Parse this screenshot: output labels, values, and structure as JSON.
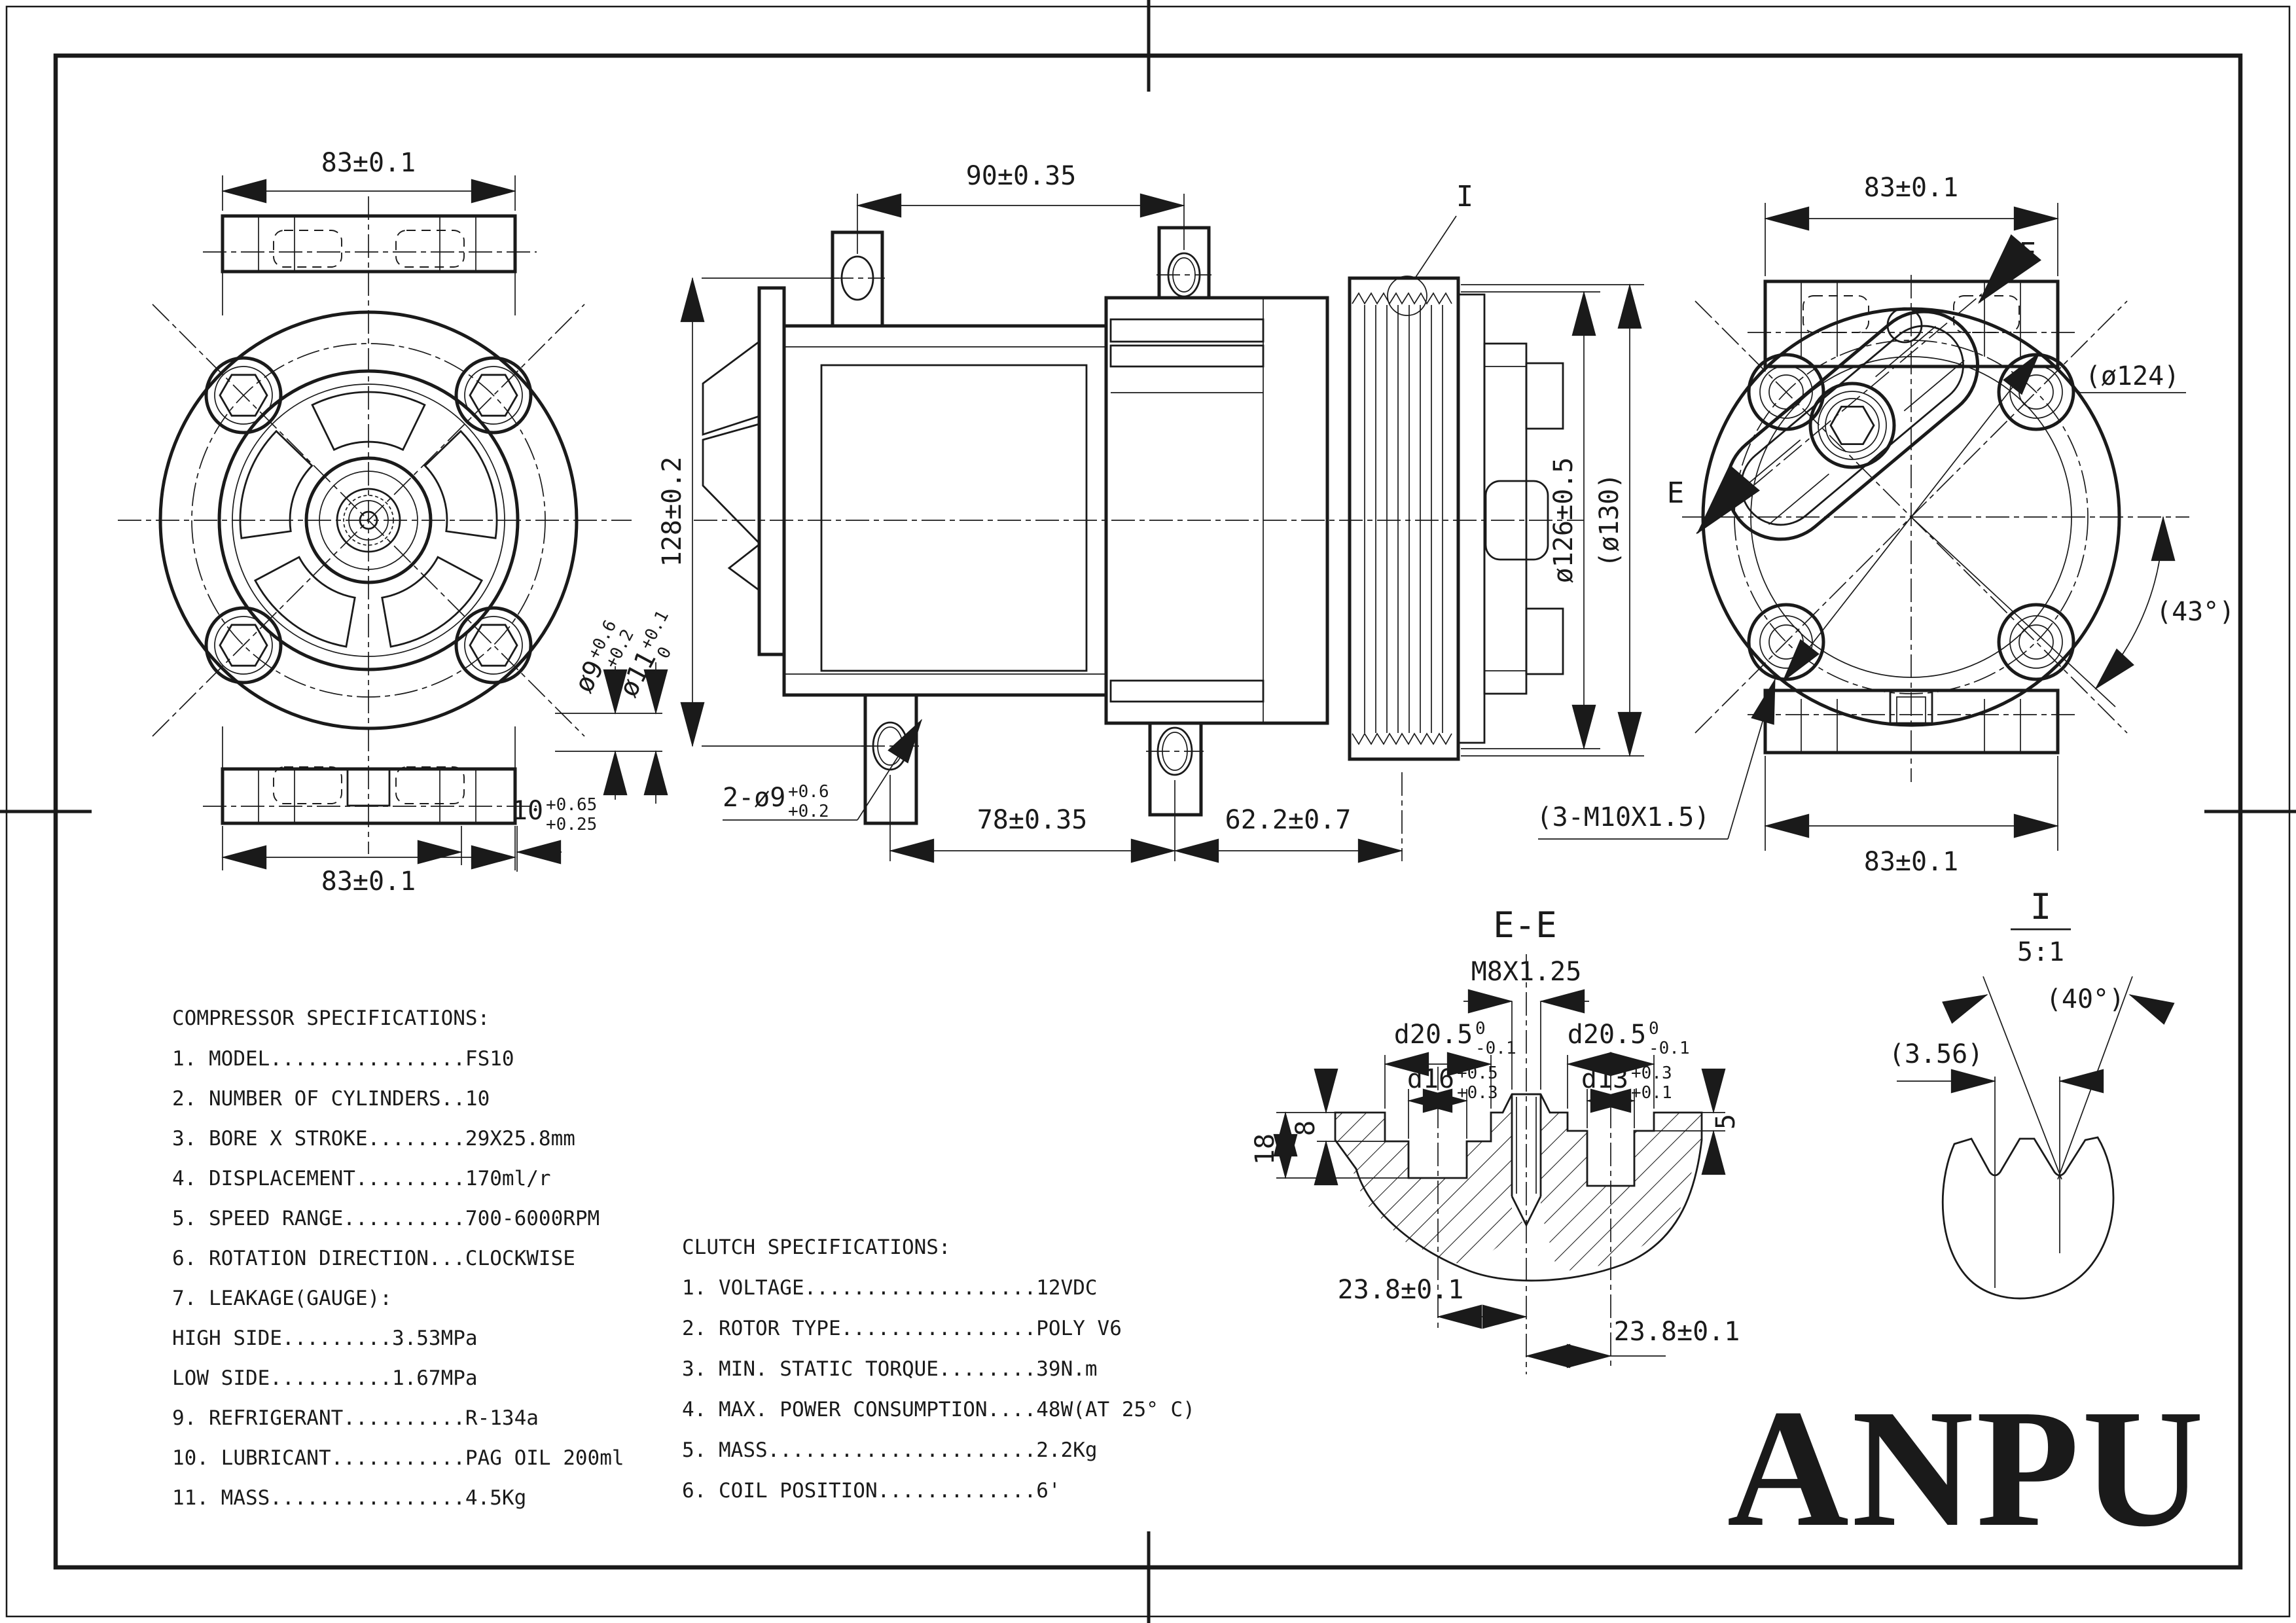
{
  "page": {
    "background": "#ffffff",
    "ink": "#1a1a1a"
  },
  "views": {
    "front_view": {
      "dim_width_top": "83±0.1",
      "dim_width_bottom": "83±0.1",
      "dim_lug_hole": {
        "main": "ø9",
        "sup": "+0.6",
        "sub": "+0.2"
      },
      "dim_lug_boss": {
        "main": "ø11",
        "sup": "+0.1",
        "sub": "0"
      },
      "dim_lug_depth": {
        "main": "10",
        "sup": "+0.65",
        "sub": "+0.25"
      }
    },
    "side_view": {
      "dim_top_lug_span": "90±0.35",
      "dim_body_height": "128±0.2",
      "dim_bottom_holes": {
        "main": "2-ø9",
        "sup": "+0.6",
        "sub": "+0.2"
      },
      "dim_bottom_lug_span": "78±0.35",
      "dim_pulley_offset": "62.2±0.7",
      "dim_pulley_dia": "ø126±0.5",
      "dim_pulley_dia_ref": "(ø130)",
      "detail_marker": "I"
    },
    "rear_view": {
      "dim_width_top": "83±0.1",
      "dim_width_bottom": "83±0.1",
      "dim_dia_ref": "(ø124)",
      "dim_angle_ref": "(43°)",
      "thread_callout": "(3-M10X1.5)",
      "section_label_start": "E",
      "section_label_end": "E"
    }
  },
  "section_ee": {
    "title": "E-E",
    "thread_callout": "M8X1.25",
    "dim_d205_left": {
      "main": "d20.5",
      "sup": "0",
      "sub": "-0.1"
    },
    "dim_d205_right": {
      "main": "d20.5",
      "sup": "0",
      "sub": "-0.1"
    },
    "dim_d16": {
      "main": "d16",
      "sup": "+0.5",
      "sub": "+0.3"
    },
    "dim_d13": {
      "main": "d13",
      "sup": "+0.3",
      "sub": "+0.1"
    },
    "dim_depth_18": "18",
    "dim_depth_8": "8",
    "dim_depth_5": "5",
    "dim_offset_left": "23.8±0.1",
    "dim_offset_right": "23.8±0.1"
  },
  "detail_i": {
    "label": "I",
    "scale": "5:1",
    "angle_ref": "(40°)",
    "pitch_ref": "(3.56)"
  },
  "compressor_specs": {
    "title": "COMPRESSOR SPECIFICATIONS:",
    "lines": [
      "1. MODEL................FS10",
      "2. NUMBER OF CYLINDERS..10",
      "3. BORE X STROKE........29X25.8mm",
      "4. DISPLACEMENT.........170ml/r",
      "5. SPEED RANGE..........700-6000RPM",
      "6. ROTATION DIRECTION...CLOCKWISE",
      "7. LEAKAGE(GAUGE):",
      "    HIGH SIDE.........3.53MPa",
      "    LOW SIDE..........1.67MPa",
      "9. REFRIGERANT..........R-134a",
      "10. LUBRICANT...........PAG OIL 200ml",
      "11. MASS................4.5Kg"
    ]
  },
  "clutch_specs": {
    "title": "CLUTCH SPECIFICATIONS:",
    "lines": [
      "1. VOLTAGE...................12VDC",
      "2. ROTOR TYPE................POLY V6",
      "3. MIN. STATIC TORQUE........39N.m",
      "4. MAX. POWER CONSUMPTION....48W(AT 25° C)",
      "5. MASS......................2.2Kg",
      "6. COIL POSITION.............6'"
    ]
  },
  "logo_text": "ANPU"
}
